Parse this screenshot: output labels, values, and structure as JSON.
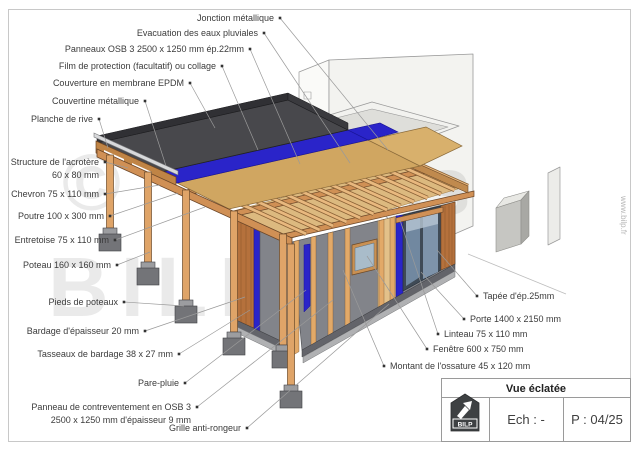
{
  "watermark": {
    "symbol": "©",
    "line1": "Plans",
    "line2": "BILP",
    "website": "www.bilp.fr"
  },
  "title_block": {
    "title": "Vue éclatée",
    "scale_label": "Ech : -",
    "page_label": "P : 04/25",
    "logo_text": "BILP"
  },
  "colors": {
    "wood_light": "#eab87e",
    "wood_mid": "#dfa468",
    "beam": "#d09055",
    "cladding": "#b5713c",
    "epdm": "#48484c",
    "film_blue": "#2a24c9",
    "osb": "#d0a661",
    "panel_gray": "#82848a",
    "concrete": "#77787a",
    "line_gray": "#9a9a9a",
    "label_text": "#3b3b3b"
  },
  "callouts": [
    {
      "id": "jonction-metallique",
      "side": "left",
      "lines": [
        "Jonction métallique"
      ],
      "dot": [
        280,
        18
      ],
      "target": [
        388,
        150
      ]
    },
    {
      "id": "evacuation-eaux-pluviales",
      "side": "left",
      "lines": [
        "Evacuation des eaux pluviales"
      ],
      "dot": [
        264,
        33
      ],
      "target": [
        350,
        163
      ]
    },
    {
      "id": "panneaux-osb",
      "side": "left",
      "lines": [
        "Panneaux OSB 3 2500 x 1250 mm ép.22mm"
      ],
      "dot": [
        250,
        49
      ],
      "target": [
        300,
        164
      ]
    },
    {
      "id": "film-protection",
      "side": "left",
      "lines": [
        "Film de protection (facultatif) ou collage"
      ],
      "dot": [
        222,
        66
      ],
      "target": [
        258,
        150
      ]
    },
    {
      "id": "couverture-epdm",
      "side": "left",
      "lines": [
        "Couverture en membrane EPDM"
      ],
      "dot": [
        190,
        83
      ],
      "target": [
        215,
        128
      ]
    },
    {
      "id": "couvertine-metallique",
      "side": "left",
      "lines": [
        "Couvertine métallique"
      ],
      "dot": [
        145,
        101
      ],
      "target": [
        166,
        166
      ]
    },
    {
      "id": "planche-de-rive",
      "side": "left",
      "lines": [
        "Planche de rive"
      ],
      "dot": [
        99,
        119
      ],
      "target": [
        108,
        148
      ]
    },
    {
      "id": "structure-acrotere",
      "side": "left",
      "lines": [
        "Structure de l'acrotère",
        "60 x 80 mm"
      ],
      "dot": [
        105,
        162
      ],
      "target": [
        128,
        168
      ]
    },
    {
      "id": "chevron",
      "side": "left",
      "lines": [
        "Chevron 75 x 110 mm"
      ],
      "dot": [
        105,
        194
      ],
      "target": [
        160,
        185
      ]
    },
    {
      "id": "poutre",
      "side": "left",
      "lines": [
        "Poutre 100 x 300 mm"
      ],
      "dot": [
        110,
        216
      ],
      "target": [
        178,
        193
      ]
    },
    {
      "id": "entretoise",
      "side": "left",
      "lines": [
        "Entretoise 75 x 110 mm"
      ],
      "dot": [
        115,
        240
      ],
      "target": [
        205,
        207
      ]
    },
    {
      "id": "poteau",
      "side": "left",
      "lines": [
        "Poteau 160 x 160 mm"
      ],
      "dot": [
        117,
        265
      ],
      "target": [
        150,
        252
      ]
    },
    {
      "id": "pieds-de-poteaux",
      "side": "left",
      "lines": [
        "Pieds de poteaux"
      ],
      "dot": [
        124,
        302
      ],
      "target": [
        184,
        306
      ]
    },
    {
      "id": "bardage",
      "side": "left",
      "lines": [
        "Bardage d'épaisseur 20 mm"
      ],
      "dot": [
        145,
        331
      ],
      "target": [
        245,
        297
      ]
    },
    {
      "id": "tasseaux-bardage",
      "side": "left",
      "lines": [
        "Tasseaux de bardage 38 x 27 mm"
      ],
      "dot": [
        179,
        354
      ],
      "target": [
        250,
        310
      ]
    },
    {
      "id": "pare-pluie",
      "side": "left",
      "lines": [
        "Pare-pluie"
      ],
      "dot": [
        185,
        383
      ],
      "target": [
        306,
        290
      ]
    },
    {
      "id": "panneau-contreventement",
      "side": "left",
      "lines": [
        "Panneau de contreventement en OSB 3",
        "2500 x 1250 mm d'épaisseur 9 mm"
      ],
      "dot": [
        197,
        407
      ],
      "target": [
        333,
        300
      ]
    },
    {
      "id": "grille-anti-rongeur",
      "side": "left",
      "lines": [
        "Grille anti-rongeur"
      ],
      "dot": [
        247,
        428
      ],
      "target": [
        389,
        304
      ]
    },
    {
      "id": "tapee",
      "side": "right",
      "lines": [
        "Tapée d'ép.25mm"
      ],
      "dot": [
        477,
        296
      ],
      "target": [
        437,
        250
      ]
    },
    {
      "id": "porte",
      "side": "right",
      "lines": [
        "Porte 1400 x 2150 mm"
      ],
      "dot": [
        464,
        319
      ],
      "target": [
        421,
        272
      ]
    },
    {
      "id": "linteau",
      "side": "right",
      "lines": [
        "Linteau 75 x 110 mm"
      ],
      "dot": [
        438,
        334
      ],
      "target": [
        400,
        220
      ]
    },
    {
      "id": "fenetre",
      "side": "right",
      "lines": [
        "Fenêtre  600 x 750 mm"
      ],
      "dot": [
        427,
        349
      ],
      "target": [
        367,
        256
      ]
    },
    {
      "id": "montant-ossature",
      "side": "right",
      "lines": [
        "Montant de l'ossature 45 x 120 mm"
      ],
      "dot": [
        384,
        366
      ],
      "target": [
        343,
        270
      ]
    }
  ]
}
